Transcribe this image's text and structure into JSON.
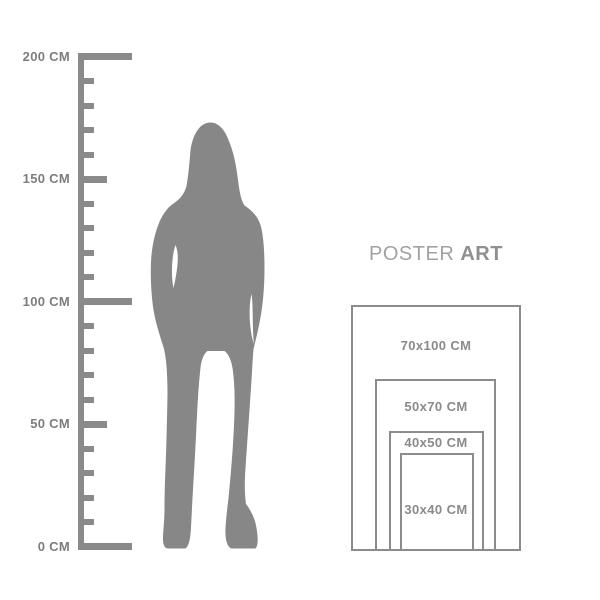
{
  "page": {
    "background_color": "#ffffff"
  },
  "ruler": {
    "unit": "CM",
    "max_cm": 200,
    "tick_step_cm": 10,
    "color": "#8a8a8a",
    "label_color": "#7d7d7d",
    "labels": [
      {
        "cm": 200,
        "label": "200 CM"
      },
      {
        "cm": 150,
        "label": "150 CM"
      },
      {
        "cm": 100,
        "label": "100 CM"
      },
      {
        "cm": 50,
        "label": "50 CM"
      },
      {
        "cm": 0,
        "label": "0 CM"
      }
    ]
  },
  "figure": {
    "description": "standing-woman-silhouette",
    "color": "#878787"
  },
  "poster": {
    "title_regular": "POSTER",
    "title_bold": "ART",
    "title_color_regular": "#a2a2a2",
    "title_color_bold": "#8f8f8f",
    "border_color": "#8c8c8c",
    "label_color": "#8a8a8a",
    "sizes": [
      {
        "label": "70x100 CM",
        "width_cm": 70,
        "height_cm": 100
      },
      {
        "label": "50x70 CM",
        "width_cm": 50,
        "height_cm": 70
      },
      {
        "label": "40x50 CM",
        "width_cm": 40,
        "height_cm": 50
      },
      {
        "label": "30x40 CM",
        "width_cm": 30,
        "height_cm": 40
      }
    ]
  }
}
